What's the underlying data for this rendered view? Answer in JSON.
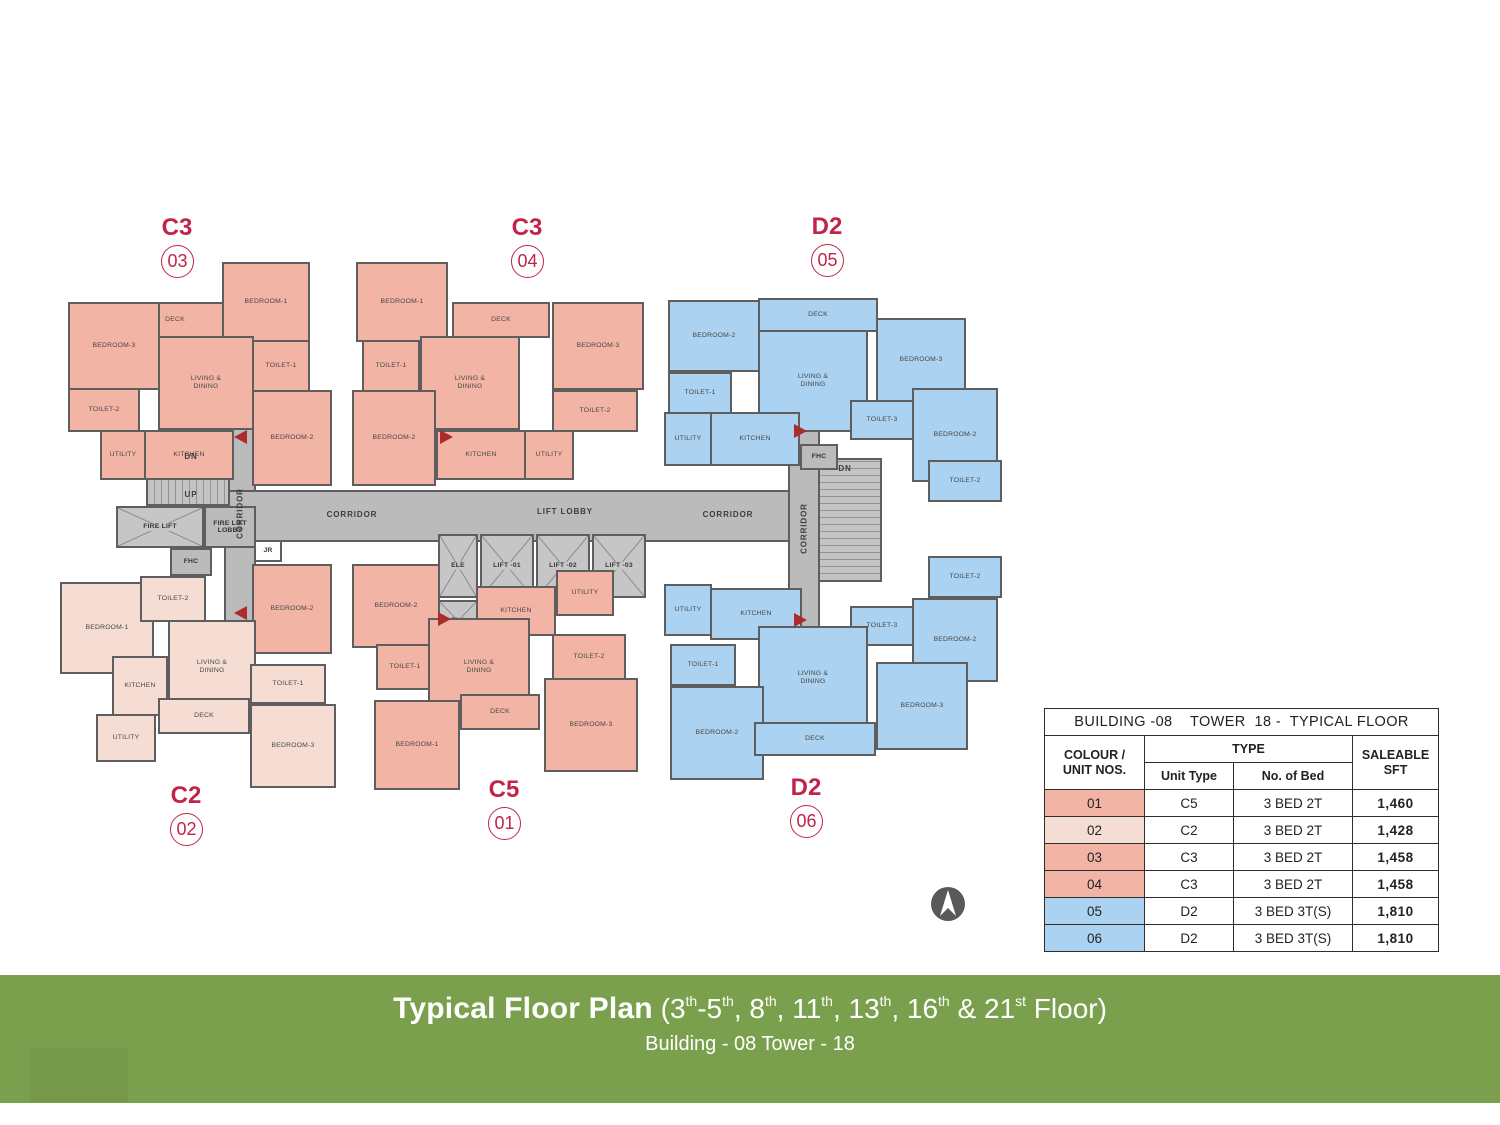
{
  "colors": {
    "salmon": "#F2B4A4",
    "lightpink": "#F6DDD4",
    "blue": "#ABD2F0",
    "corridor_gray": "#BBBBBB",
    "wall": "#5E5E5E",
    "label_red": "#C22349",
    "arrow_red": "#AD2B2B",
    "footer_green": "#7AA04D",
    "compass_gray": "#58595B"
  },
  "floorplan": {
    "unit_labels": [
      {
        "code": "C3",
        "num": "03",
        "x": 177,
        "y": 214
      },
      {
        "code": "C3",
        "num": "04",
        "x": 527,
        "y": 214
      },
      {
        "code": "D2",
        "num": "05",
        "x": 827,
        "y": 213
      },
      {
        "code": "C2",
        "num": "02",
        "x": 186,
        "y": 782
      },
      {
        "code": "C5",
        "num": "01",
        "x": 504,
        "y": 776
      },
      {
        "code": "D2",
        "num": "06",
        "x": 806,
        "y": 774
      }
    ],
    "rooms": [
      [
        222,
        262,
        88,
        80,
        "BEDROOM-1",
        "s"
      ],
      [
        126,
        302,
        98,
        36,
        "DECK",
        "s"
      ],
      [
        68,
        302,
        92,
        88,
        "BEDROOM-3",
        "s"
      ],
      [
        252,
        340,
        58,
        52,
        "TOILET-1",
        "s"
      ],
      [
        158,
        336,
        96,
        94,
        "LIVING & DINING",
        "s"
      ],
      [
        68,
        388,
        72,
        44,
        "TOILET-2",
        "s"
      ],
      [
        100,
        430,
        46,
        50,
        "UTILITY",
        "s"
      ],
      [
        144,
        430,
        90,
        50,
        "KITCHEN",
        "s"
      ],
      [
        252,
        390,
        80,
        96,
        "BEDROOM-2",
        "s"
      ],
      [
        356,
        262,
        92,
        80,
        "BEDROOM-1",
        "s"
      ],
      [
        452,
        302,
        98,
        36,
        "DECK",
        "s"
      ],
      [
        552,
        302,
        92,
        88,
        "BEDROOM-3",
        "s"
      ],
      [
        362,
        340,
        58,
        52,
        "TOILET-1",
        "s"
      ],
      [
        420,
        336,
        100,
        94,
        "LIVING & DINING",
        "s"
      ],
      [
        352,
        390,
        84,
        96,
        "BEDROOM-2",
        "s"
      ],
      [
        436,
        430,
        90,
        50,
        "KITCHEN",
        "s"
      ],
      [
        524,
        430,
        50,
        50,
        "UTILITY",
        "s"
      ],
      [
        552,
        390,
        86,
        42,
        "TOILET-2",
        "s"
      ],
      [
        668,
        300,
        92,
        72,
        "BEDROOM-2",
        "b"
      ],
      [
        758,
        298,
        120,
        34,
        "DECK",
        "b"
      ],
      [
        758,
        330,
        110,
        102,
        "LIVING & DINING",
        "b"
      ],
      [
        876,
        318,
        90,
        84,
        "BEDROOM-3",
        "b"
      ],
      [
        668,
        372,
        64,
        42,
        "TOILET-1",
        "b"
      ],
      [
        664,
        412,
        48,
        54,
        "UTILITY",
        "b"
      ],
      [
        710,
        412,
        90,
        54,
        "KITCHEN",
        "b"
      ],
      [
        850,
        400,
        64,
        40,
        "TOILET-3",
        "b"
      ],
      [
        912,
        388,
        86,
        94,
        "BEDROOM-2",
        "b"
      ],
      [
        928,
        460,
        74,
        42,
        "TOILET-2",
        "b"
      ],
      [
        60,
        582,
        94,
        92,
        "BEDROOM-1",
        "p"
      ],
      [
        140,
        576,
        66,
        46,
        "TOILET-2",
        "p"
      ],
      [
        252,
        564,
        80,
        90,
        "BEDROOM-2",
        "s"
      ],
      [
        168,
        620,
        88,
        94,
        "LIVING & DINING",
        "p"
      ],
      [
        112,
        656,
        56,
        60,
        "KITCHEN",
        "p"
      ],
      [
        250,
        664,
        76,
        40,
        "TOILET-1",
        "p"
      ],
      [
        96,
        714,
        60,
        48,
        "UTILITY",
        "p"
      ],
      [
        158,
        698,
        92,
        36,
        "DECK",
        "p"
      ],
      [
        250,
        704,
        86,
        84,
        "BEDROOM-3",
        "p"
      ],
      [
        352,
        564,
        88,
        84,
        "BEDROOM-2",
        "s"
      ],
      [
        476,
        586,
        80,
        50,
        "KITCHEN",
        "s"
      ],
      [
        556,
        570,
        58,
        46,
        "UTILITY",
        "s"
      ],
      [
        376,
        644,
        58,
        46,
        "TOILET-1",
        "s"
      ],
      [
        428,
        618,
        102,
        98,
        "LIVING & DINING",
        "s"
      ],
      [
        552,
        634,
        74,
        46,
        "TOILET-2",
        "s"
      ],
      [
        544,
        678,
        94,
        94,
        "BEDROOM-3",
        "s"
      ],
      [
        460,
        694,
        80,
        36,
        "DECK",
        "s"
      ],
      [
        374,
        700,
        86,
        90,
        "BEDROOM-1",
        "s"
      ],
      [
        664,
        584,
        48,
        52,
        "UTILITY",
        "b"
      ],
      [
        710,
        588,
        92,
        52,
        "KITCHEN",
        "b"
      ],
      [
        928,
        556,
        74,
        42,
        "TOILET-2",
        "b"
      ],
      [
        912,
        598,
        86,
        84,
        "BEDROOM-2",
        "b"
      ],
      [
        850,
        606,
        64,
        40,
        "TOILET-3",
        "b"
      ],
      [
        670,
        644,
        66,
        42,
        "TOILET-1",
        "b"
      ],
      [
        758,
        626,
        110,
        104,
        "LIVING & DINING",
        "b"
      ],
      [
        670,
        686,
        94,
        94,
        "BEDROOM-2",
        "b"
      ],
      [
        876,
        662,
        92,
        88,
        "BEDROOM-3",
        "b"
      ],
      [
        754,
        722,
        122,
        34,
        "DECK",
        "b"
      ]
    ],
    "cores": [
      [
        224,
        396,
        32,
        246,
        "",
        "plain"
      ],
      [
        224,
        490,
        658,
        52,
        "",
        "plain"
      ],
      [
        788,
        420,
        32,
        226,
        "",
        "plain"
      ],
      [
        146,
        446,
        84,
        60,
        "",
        "stairs-h"
      ],
      [
        116,
        506,
        88,
        42,
        "FIRE LIFT",
        "cross"
      ],
      [
        204,
        506,
        52,
        42,
        "FIRE LIFT LOBBY",
        "plain"
      ],
      [
        170,
        548,
        42,
        28,
        "FHC",
        "plain"
      ],
      [
        438,
        534,
        40,
        64,
        "ELE",
        "cross"
      ],
      [
        480,
        534,
        54,
        64,
        "LIFT -01",
        "cross"
      ],
      [
        536,
        534,
        54,
        64,
        "LIFT -02",
        "cross"
      ],
      [
        592,
        534,
        54,
        64,
        "LIFT -03",
        "cross"
      ],
      [
        438,
        600,
        40,
        42,
        "ELV",
        "cross"
      ],
      [
        818,
        458,
        64,
        124,
        "",
        "stairs-v"
      ],
      [
        800,
        444,
        38,
        26,
        "FHC",
        "plain"
      ],
      [
        254,
        540,
        28,
        22,
        "JR",
        "light"
      ]
    ],
    "labels": [
      [
        "DN",
        176,
        452,
        30,
        false
      ],
      [
        "UP",
        176,
        490,
        30,
        false
      ],
      [
        "DN",
        830,
        464,
        30,
        false
      ],
      [
        "CORRIDOR",
        307,
        510,
        90,
        false
      ],
      [
        "LIFT LOBBY",
        510,
        507,
        110,
        false
      ],
      [
        "CORRIDOR",
        683,
        510,
        90,
        false
      ],
      [
        "CORRIDOR",
        195,
        509,
        90,
        true
      ],
      [
        "CORRIDOR",
        759,
        524,
        90,
        true
      ]
    ],
    "arrows": [
      [
        234,
        430,
        "l"
      ],
      [
        440,
        430,
        "r"
      ],
      [
        794,
        424,
        "r"
      ],
      [
        234,
        606,
        "l"
      ],
      [
        438,
        612,
        "r"
      ],
      [
        794,
        613,
        "r"
      ]
    ]
  },
  "table": {
    "title": "BUILDING -08    TOWER  18 -  TYPICAL FLOOR",
    "colour_header": [
      "COLOUR /",
      "UNIT NOS."
    ],
    "type_header": "TYPE",
    "unit_type_header": "Unit Type",
    "bed_header": "No. of Bed",
    "saleable_header": [
      "SALEABLE",
      "SFT"
    ],
    "rows": [
      {
        "no": "01",
        "f": "s",
        "type": "C5",
        "bed": "3 BED 2T",
        "sft": "1,460"
      },
      {
        "no": "02",
        "f": "p",
        "type": "C2",
        "bed": "3 BED 2T",
        "sft": "1,428"
      },
      {
        "no": "03",
        "f": "s",
        "type": "C3",
        "bed": "3 BED 2T",
        "sft": "1,458"
      },
      {
        "no": "04",
        "f": "s",
        "type": "C3",
        "bed": "3 BED 2T",
        "sft": "1,458"
      },
      {
        "no": "05",
        "f": "b",
        "type": "D2",
        "bed": "3 BED 3T(S)",
        "sft": "1,810"
      },
      {
        "no": "06",
        "f": "b",
        "type": "D2",
        "bed": "3 BED 3T(S)",
        "sft": "1,810"
      }
    ]
  },
  "footer": {
    "title_bold": "Typical Floor Plan",
    "floors_segments": [
      {
        "t": " ("
      },
      {
        "t": "3"
      },
      {
        "s": "th"
      },
      {
        "t": "-5"
      },
      {
        "s": "th"
      },
      {
        "t": ", 8"
      },
      {
        "s": "th"
      },
      {
        "t": ", 11"
      },
      {
        "s": "th"
      },
      {
        "t": ", 13"
      },
      {
        "s": "th"
      },
      {
        "t": ", 16"
      },
      {
        "s": "th"
      },
      {
        "t": " & 21"
      },
      {
        "s": "st"
      },
      {
        "t": " Floor)"
      }
    ],
    "subtitle": "Building - 08 Tower - 18"
  }
}
